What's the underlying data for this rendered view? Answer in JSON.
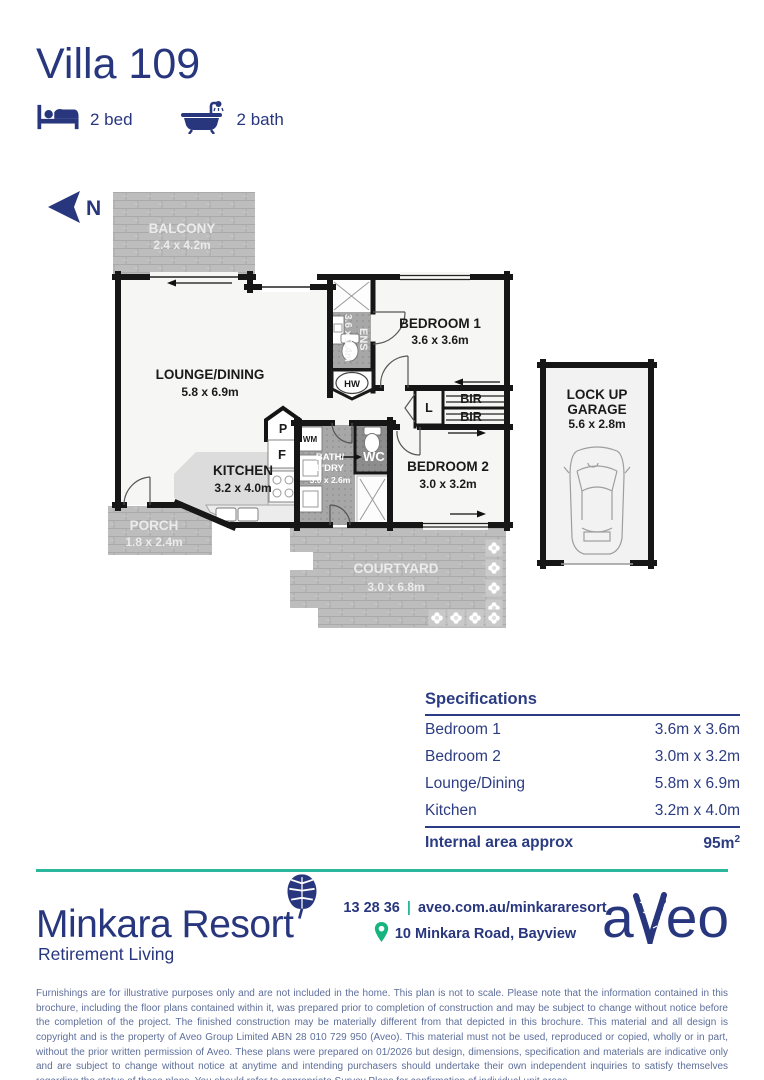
{
  "header": {
    "title": "Villa 109",
    "bed": "2 bed",
    "bath": "2 bath"
  },
  "north": {
    "label": "N"
  },
  "plan": {
    "balcony_name": "BALCONY",
    "balcony_dims": "2.4 x 4.2m",
    "lounge_name": "LOUNGE/DINING",
    "lounge_dims": "5.8 x 6.9m",
    "ens_name": "ENS",
    "ens_dims": "3.6 x 1.4m",
    "bed1_name": "BEDROOM 1",
    "bed1_dims": "3.6 x 3.6m",
    "bed2_name": "BEDROOM 2",
    "bed2_dims": "3.0 x 3.2m",
    "kitchen_name": "KITCHEN",
    "kitchen_dims": "3.2 x 4.0m",
    "bath_name1": "BATH/",
    "bath_name2": "L'DRY",
    "bath_dims": "3.0 x 2.6m",
    "wc": "WC",
    "porch_name": "PORCH",
    "porch_dims": "1.8 x 2.4m",
    "courtyard_name": "COURTYARD",
    "courtyard_dims": "3.0 x 6.8m",
    "garage_name1": "LOCK UP",
    "garage_name2": "GARAGE",
    "garage_dims": "5.6 x 2.8m",
    "hw": "HW",
    "wm": "WM",
    "pantry": "P",
    "fridge": "F",
    "linen": "L",
    "bir1": "BIR",
    "bir2": "BIR"
  },
  "specs": {
    "title": "Specifications",
    "rows": [
      {
        "label": "Bedroom 1",
        "value": "3.6m x 3.6m"
      },
      {
        "label": "Bedroom 2",
        "value": "3.0m x 3.2m"
      },
      {
        "label": "Lounge/Dining",
        "value": "5.8m x 6.9m"
      },
      {
        "label": "Kitchen",
        "value": "3.2m x 4.0m"
      }
    ],
    "total_label": "Internal area approx",
    "total_value": "95m",
    "total_sup": "2"
  },
  "footer": {
    "resort": "Minkara Resort",
    "tagline": "Retirement Living",
    "phone": "13 28 36",
    "pipe": "|",
    "site": "aveo.com.au/minkararesort",
    "address": "10 Minkara Road, Bayview",
    "brand_left": "a",
    "brand_right": "eo"
  },
  "disclaimer": {
    "text": "Furnishings are for illustrative purposes only and are not included in the home. This plan is not to scale. Please note that the information contained in this brochure, including the floor plans contained within it, was prepared prior to completion of construction and may be subject to change without notice before the completion of the project. The finished construction may be materially different from that depicted in this brochure. This material and all design is copyright and is the property of Aveo Group Limited ABN 28 010 729 950 (Aveo). This material must not be used, reproduced or copied, wholly or in part, without the prior written permission of Aveo. These plans were prepared on 01/2026 but design, dimensions, specification and materials are indicative only and are subject to change without notice at anytime and intending purchasers should undertake their own independent inquiries to satisfy themselves regarding the status of these plans. You should refer to appropriate Survey Plans for confirmation of individual unit areas."
  },
  "colors": {
    "navy": "#28367e",
    "teal": "#2bb79b",
    "pin_green": "#16b47f"
  }
}
